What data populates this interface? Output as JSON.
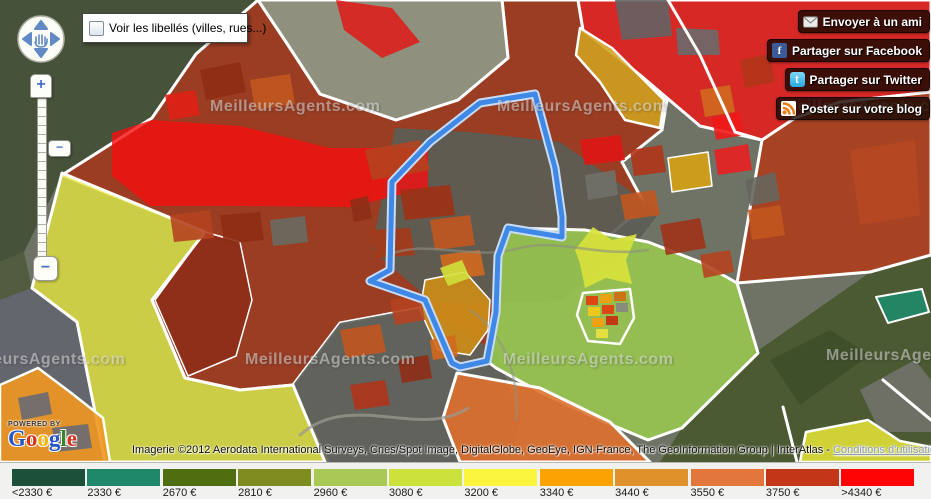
{
  "controls": {
    "labels_checkbox_label": "Voir les libellés (villes, rues...)",
    "labels_checkbox_checked": false
  },
  "zoom_control": {
    "zoom_in": "+",
    "zoom_out": "−",
    "thumb": "−"
  },
  "share_buttons": [
    {
      "icon": "email-icon",
      "label": "Envoyer à un ami"
    },
    {
      "icon": "facebook-icon",
      "label": "Partager sur Facebook",
      "icon_letter": "f"
    },
    {
      "icon": "twitter-icon",
      "label": "Partager sur Twitter",
      "icon_letter": "t"
    },
    {
      "icon": "rss-icon",
      "label": "Poster sur votre blog"
    }
  ],
  "google_logo": {
    "powered_by": "POWERED BY",
    "brand": "Google",
    "letters": [
      {
        "ch": "G",
        "color": "#2458c8"
      },
      {
        "ch": "o",
        "color": "#d8321f"
      },
      {
        "ch": "o",
        "color": "#f2b50f"
      },
      {
        "ch": "g",
        "color": "#2458c8"
      },
      {
        "ch": "l",
        "color": "#38862a"
      },
      {
        "ch": "e",
        "color": "#d8321f"
      }
    ]
  },
  "attribution": {
    "text": "Imagerie ©2012 Aerodata International Surveys, Cnes/Spot Image, DigitalGlobe, GeoEye, IGN-France, The GeoInformation Group | InterAtlas - ",
    "link": "Conditions d'utilisation"
  },
  "legend": {
    "items": [
      {
        "label": "<2330 €",
        "color": "#1d5038"
      },
      {
        "label": "2330 €",
        "color": "#20886a"
      },
      {
        "label": "2670 €",
        "color": "#4e6e10"
      },
      {
        "label": "2810 €",
        "color": "#7e8b1e"
      },
      {
        "label": "2960 €",
        "color": "#a9c854"
      },
      {
        "label": "3080 €",
        "color": "#cbe23c"
      },
      {
        "label": "3200 €",
        "color": "#fbf53d"
      },
      {
        "label": "3340 €",
        "color": "#fba303"
      },
      {
        "label": "3440 €",
        "color": "#e0922a"
      },
      {
        "label": "3550 €",
        "color": "#e2763b"
      },
      {
        "label": "3750 €",
        "color": "#c33617"
      },
      {
        "label": ">4340 €",
        "color": "#fe0404"
      }
    ]
  },
  "map": {
    "watermark_text": "MeilleursAgents.com",
    "watermark_positions": [
      {
        "x": 210,
        "y": 98
      },
      {
        "x": 497,
        "y": 98
      },
      {
        "x": 784,
        "y": 98
      },
      {
        "x": -45,
        "y": 351
      },
      {
        "x": 245,
        "y": 351
      },
      {
        "x": 503,
        "y": 351
      },
      {
        "x": 826,
        "y": 347
      }
    ],
    "selection_outline": {
      "points": "535,94 480,103 430,142 392,182 390,270 370,281 425,300 452,363 460,367 487,361 496,312 498,256 508,228 562,237 562,217 555,168",
      "casing_color": "#c9dcf6",
      "core_color": "#3f88e6"
    },
    "regions": [
      {
        "name": "satellite-base",
        "points": "0,0 931,0 931,462 0,462",
        "fill": "#6f7366",
        "interactable": false
      },
      {
        "name": "satellite-forest-topleft",
        "points": "0,0 258,0 196,54 152,118 62,175 24,252 0,262",
        "fill": "#47523a",
        "interactable": false
      },
      {
        "name": "satellite-left-strip",
        "points": "0,262 24,252 32,288 0,330",
        "fill": "#525d40",
        "interactable": false
      },
      {
        "name": "satellite-gray-bottomleft",
        "points": "0,300 32,288 77,322 105,462 0,462",
        "fill": "#64666d",
        "interactable": false
      },
      {
        "name": "satellite-fields-bottomright",
        "points": "660,462 682,428 756,352 872,271 931,257 931,462",
        "fill": "#4b5a32",
        "interactable": false
      },
      {
        "name": "satellite-fields-br-dark",
        "points": "770,360 830,330 870,355 800,405",
        "fill": "#3f4f2a",
        "interactable": false
      },
      {
        "name": "satellite-fields-br-gray",
        "points": "860,390 915,360 931,380 931,432 880,432",
        "fill": "#6e7066",
        "interactable": false
      },
      {
        "name": "region-dark-red-main",
        "points": "152,118 196,54 258,0 286,42 320,94 396,120 458,100 508,58 502,0 578,0 583,30 640,75 667,100 662,130 622,162 645,205 610,235 510,228 498,252 494,312 487,361 460,367 452,363 425,300 420,308 340,323 293,385 240,390 185,378 152,300 205,232 62,175",
        "fill": "#a23418",
        "opacity": 0.85,
        "stroke": "#ffffff",
        "strokeWidth": 3,
        "interactable": true
      },
      {
        "name": "region-gray-bottommiddle",
        "points": "293,385 340,323 420,308 497,352 520,420 512,462 330,462",
        "fill": "#5f615a",
        "opacity": 0.92,
        "interactable": true
      },
      {
        "name": "satellite-field-wedge",
        "points": "258,0 286,42 320,94 396,120 458,100 508,58 502,0",
        "fill": "#8f917e",
        "stroke": "#ffffff",
        "strokeWidth": 3,
        "interactable": false
      },
      {
        "name": "region-gray-urban",
        "points": "372,250 395,128 470,132 560,142 660,212 640,238 560,300 470,305 430,300",
        "fill": "#5b5d56",
        "opacity": 0.92,
        "interactable": true
      },
      {
        "name": "region-red-band",
        "points": "112,133 152,120 240,126 330,148 428,148 428,188 350,207 240,206 150,206 112,176",
        "fill": "#f50f0f",
        "opacity": 0.8,
        "interactable": true
      },
      {
        "name": "region-red-top-small",
        "points": "336,0 392,8 420,42 382,58 344,30",
        "fill": "#e51212",
        "opacity": 0.8,
        "interactable": true
      },
      {
        "name": "region-red-topright",
        "points": "578,0 931,0 931,92 840,102 795,118 762,140 700,126 640,75 583,30",
        "fill": "#f41414",
        "opacity": 0.78,
        "stroke": "#ffffff",
        "strokeWidth": 3,
        "interactable": true
      },
      {
        "name": "satellite-gray-tr-1",
        "points": "615,0 668,0 672,36 622,40",
        "fill": "#636363",
        "opacity": 0.9,
        "interactable": false
      },
      {
        "name": "satellite-gray-tr-2",
        "points": "676,28 718,30 720,55 678,55",
        "fill": "#6a6a6a",
        "opacity": 0.9,
        "interactable": false
      },
      {
        "name": "region-gold-top",
        "points": "580,28 612,48 640,76 664,100 660,128 625,120 600,82 576,55",
        "fill": "#d2a31f",
        "opacity": 0.88,
        "stroke": "#ffffff",
        "strokeWidth": 2.5,
        "interactable": true
      },
      {
        "name": "region-brick-right",
        "points": "762,140 795,118 840,102 931,92 931,255 870,272 737,283",
        "fill": "#b23a18",
        "opacity": 0.85,
        "stroke": "#ffffff",
        "strokeWidth": 3,
        "interactable": true
      },
      {
        "name": "region-brick-right-light",
        "points": "850,150 915,140 920,215 860,225",
        "fill": "#c84e22",
        "opacity": 0.45,
        "interactable": false
      },
      {
        "name": "region-lightgreen",
        "points": "510,228 585,230 648,242 700,262 737,283 758,353 682,428 648,440 600,420 540,392 496,368 487,361 494,312 498,252",
        "fill": "#9bcb4d",
        "opacity": 0.85,
        "stroke": "#ffffff",
        "strokeWidth": 3,
        "interactable": true
      },
      {
        "name": "region-darkbrick-left",
        "points": "205,232 240,242 252,300 236,356 188,376 155,300",
        "fill": "#8f2e18",
        "opacity": 0.9,
        "stroke": "#ffffff",
        "strokeWidth": 1.5,
        "interactable": true
      },
      {
        "name": "region-yellow-left",
        "points": "62,173 205,232 152,300 185,378 240,390 293,385 325,462 105,462 77,322 32,288",
        "fill": "#e7e73e",
        "opacity": 0.78,
        "stroke": "#ffffff",
        "strokeWidth": 3,
        "interactable": true
      },
      {
        "name": "region-orange-bottomleft",
        "points": "0,385 38,368 70,392 103,418 110,462 0,462",
        "fill": "#ef9721",
        "opacity": 0.9,
        "stroke": "#ffffff",
        "strokeWidth": 2.5,
        "interactable": true
      },
      {
        "name": "satellite-gray-obl-1",
        "points": "18,398 48,392 52,414 22,420",
        "fill": "#6a6a72",
        "opacity": 0.9,
        "interactable": false
      },
      {
        "name": "satellite-gray-obl-2",
        "points": "52,428 88,424 92,448 56,452",
        "fill": "#6a6a72",
        "opacity": 0.9,
        "interactable": false
      },
      {
        "name": "region-orange-bottom",
        "points": "457,373 540,388 610,422 650,462 460,462 443,418",
        "fill": "#e0702e",
        "opacity": 0.9,
        "stroke": "#ffffff",
        "strokeWidth": 3,
        "interactable": true
      },
      {
        "name": "region-yellow-bottomright",
        "points": "806,432 868,420 900,441 931,447 931,462 800,462",
        "fill": "#e6e636",
        "opacity": 0.85,
        "stroke": "#ffffff",
        "strokeWidth": 2.5,
        "interactable": true
      },
      {
        "name": "region-teal-bottomright",
        "points": "876,297 922,289 929,312 888,323",
        "fill": "#1f8a68",
        "opacity": 0.9,
        "stroke": "#ffffff",
        "strokeWidth": 2,
        "interactable": true
      },
      {
        "name": "parcel",
        "points": "365,150 420,140 430,170 372,180",
        "fill": "#b5431f",
        "opacity": 0.9,
        "interactable": true
      },
      {
        "name": "parcel",
        "points": "400,190 450,185 455,215 405,220",
        "fill": "#9e3014",
        "opacity": 0.9,
        "interactable": true
      },
      {
        "name": "parcel",
        "points": "430,220 470,215 475,245 435,250",
        "fill": "#c2561f",
        "opacity": 0.9,
        "interactable": true
      },
      {
        "name": "parcel",
        "points": "370,230 410,228 415,255 375,258",
        "fill": "#a53a18",
        "opacity": 0.9,
        "interactable": true
      },
      {
        "name": "parcel",
        "points": "440,255 480,250 485,275 445,280",
        "fill": "#d2691e",
        "opacity": 0.9,
        "interactable": true
      },
      {
        "name": "parcel-gold-center",
        "points": "425,280 465,272 490,300 488,330 470,355 438,350 420,310",
        "fill": "#cc8c18",
        "opacity": 0.92,
        "stroke": "#ffffff",
        "strokeWidth": 1.5,
        "interactable": true
      },
      {
        "name": "parcel",
        "points": "440,268 462,260 470,278 448,286",
        "fill": "#cfe03c",
        "opacity": 0.9,
        "interactable": true
      },
      {
        "name": "parcel",
        "points": "350,200 368,196 372,218 354,222",
        "fill": "#8f2e16",
        "opacity": 0.9,
        "interactable": true
      },
      {
        "name": "parcel",
        "points": "390,300 420,295 425,320 395,325",
        "fill": "#b5431f",
        "opacity": 0.9,
        "interactable": true
      },
      {
        "name": "parcel",
        "points": "430,340 455,335 458,356 433,360",
        "fill": "#d2691e",
        "opacity": 0.9,
        "interactable": true
      },
      {
        "name": "parcel",
        "points": "580,140 620,135 625,160 585,165",
        "fill": "#e01515",
        "opacity": 0.9,
        "interactable": true
      },
      {
        "name": "parcel",
        "points": "630,150 662,145 666,172 634,176",
        "fill": "#b03418",
        "opacity": 0.9,
        "interactable": true
      },
      {
        "name": "parcel-gold-east",
        "points": "668,158 708,152 712,186 672,192",
        "fill": "#d4a017",
        "opacity": 0.92,
        "stroke": "#ffffff",
        "strokeWidth": 1.5,
        "interactable": true
      },
      {
        "name": "parcel",
        "points": "714,150 748,144 752,170 718,175",
        "fill": "#e82020",
        "opacity": 0.9,
        "interactable": true
      },
      {
        "name": "parcel",
        "points": "585,175 615,170 618,195 588,200",
        "fill": "#707068",
        "opacity": 0.9,
        "interactable": true
      },
      {
        "name": "parcel",
        "points": "620,195 655,190 660,215 625,220",
        "fill": "#c2561f",
        "opacity": 0.9,
        "interactable": true
      },
      {
        "name": "parcel-yellow-star",
        "points": "575,250 593,227 612,240 637,234 626,260 632,284 606,278 585,288 580,264",
        "fill": "#d8e23a",
        "opacity": 0.9,
        "interactable": true
      },
      {
        "name": "parcel",
        "points": "660,225 700,218 706,248 666,255",
        "fill": "#9e3218",
        "opacity": 0.9,
        "interactable": true
      },
      {
        "name": "parcel",
        "points": "700,255 730,250 734,272 704,278",
        "fill": "#b5431f",
        "opacity": 0.9,
        "interactable": true
      },
      {
        "name": "parcel",
        "points": "712,118 740,112 744,135 716,140",
        "fill": "#f01818",
        "opacity": 0.9,
        "interactable": true
      },
      {
        "name": "parcel",
        "points": "745,180 775,172 780,200 750,206",
        "fill": "#66665e",
        "opacity": 0.9,
        "interactable": true
      },
      {
        "name": "parcel",
        "points": "748,210 780,205 785,235 752,240",
        "fill": "#c2561f",
        "opacity": 0.9,
        "interactable": true
      },
      {
        "name": "parcel",
        "points": "700,90 730,85 735,112 705,117",
        "fill": "#d2691e",
        "opacity": 0.9,
        "interactable": true
      },
      {
        "name": "parcel",
        "points": "740,60 770,54 775,82 745,88",
        "fill": "#b03418",
        "opacity": 0.9,
        "interactable": true
      },
      {
        "name": "parcel",
        "points": "200,70 240,62 246,92 206,100",
        "fill": "#8f2c14",
        "opacity": 0.9,
        "interactable": true
      },
      {
        "name": "parcel",
        "points": "250,80 290,74 295,104 255,110",
        "fill": "#c2561f",
        "opacity": 0.9,
        "interactable": true
      },
      {
        "name": "parcel",
        "points": "165,95 195,90 200,115 170,120",
        "fill": "#e02015",
        "opacity": 0.9,
        "interactable": true
      },
      {
        "name": "parcel",
        "points": "170,215 210,210 214,238 174,242",
        "fill": "#b5431f",
        "opacity": 0.9,
        "interactable": true
      },
      {
        "name": "parcel",
        "points": "220,215 260,212 264,240 224,244",
        "fill": "#8f2c14",
        "opacity": 0.9,
        "interactable": true
      },
      {
        "name": "parcel",
        "points": "270,220 305,216 308,242 273,246",
        "fill": "#6a6a62",
        "opacity": 0.9,
        "interactable": true
      },
      {
        "name": "parcel",
        "points": "340,330 380,324 386,352 346,358",
        "fill": "#c2561f",
        "opacity": 0.9,
        "interactable": true
      },
      {
        "name": "parcel",
        "points": "350,385 385,380 390,405 355,410",
        "fill": "#b03418",
        "opacity": 0.9,
        "interactable": true
      },
      {
        "name": "parcel",
        "points": "398,360 428,355 432,378 402,383",
        "fill": "#8f2e16",
        "opacity": 0.9,
        "interactable": true
      },
      {
        "name": "enclave-border",
        "points": "583,293 630,289 634,318 620,344 588,341 577,315",
        "fill": "none",
        "stroke": "#ffffff",
        "strokeWidth": 2.5,
        "interactable": false
      },
      {
        "name": "parcel",
        "points": "586,296 598,296 598,305 586,305",
        "fill": "#e04010",
        "opacity": 0.95,
        "interactable": true
      },
      {
        "name": "parcel",
        "points": "600,294 612,294 612,303 600,303",
        "fill": "#f0a010",
        "opacity": 0.95,
        "interactable": true
      },
      {
        "name": "parcel",
        "points": "614,292 626,292 626,301 614,301",
        "fill": "#d07018",
        "opacity": 0.95,
        "interactable": true
      },
      {
        "name": "parcel",
        "points": "588,307 600,307 600,316 588,316",
        "fill": "#f0c818",
        "opacity": 0.95,
        "interactable": true
      },
      {
        "name": "parcel",
        "points": "602,305 614,305 614,314 602,314",
        "fill": "#e04010",
        "opacity": 0.95,
        "interactable": true
      },
      {
        "name": "parcel",
        "points": "616,303 628,303 628,312 616,312",
        "fill": "#888880",
        "opacity": 0.95,
        "interactable": true
      },
      {
        "name": "parcel",
        "points": "592,318 604,318 604,327 592,327",
        "fill": "#f0a010",
        "opacity": 0.95,
        "interactable": true
      },
      {
        "name": "parcel",
        "points": "606,316 618,316 618,325 606,325",
        "fill": "#c83010",
        "opacity": 0.95,
        "interactable": true
      },
      {
        "name": "parcel",
        "points": "596,329 608,329 608,338 596,338",
        "fill": "#e8e040",
        "opacity": 0.95,
        "interactable": true
      },
      {
        "name": "road",
        "type": "path",
        "d": "M300,435 C350,390 420,440 468,408",
        "stroke": "#9a9a8e",
        "strokeWidth": 3,
        "opacity": 0.75,
        "interactable": false
      },
      {
        "name": "road",
        "type": "path",
        "d": "M388,255 C430,238 470,262 520,248 C560,238 600,258 648,250",
        "stroke": "#8e8e82",
        "strokeWidth": 2.5,
        "opacity": 0.6,
        "interactable": false
      },
      {
        "name": "road",
        "type": "path",
        "d": "M470,310 C500,330 520,370 516,420",
        "stroke": "#90908a",
        "strokeWidth": 2.5,
        "opacity": 0.5,
        "interactable": false
      },
      {
        "name": "boundary-line",
        "type": "polyline",
        "points": "668,0 700,55 735,132 762,140",
        "fill": "none",
        "stroke": "#ffffff",
        "strokeWidth": 3,
        "interactable": false
      },
      {
        "name": "boundary-line",
        "type": "polyline",
        "points": "783,407 797,462",
        "fill": "none",
        "stroke": "#ffffff",
        "strokeWidth": 3,
        "interactable": false
      },
      {
        "name": "boundary-line",
        "type": "polyline",
        "points": "883,380 931,420",
        "fill": "none",
        "stroke": "#ffffff",
        "strokeWidth": 3,
        "interactable": false
      }
    ]
  }
}
